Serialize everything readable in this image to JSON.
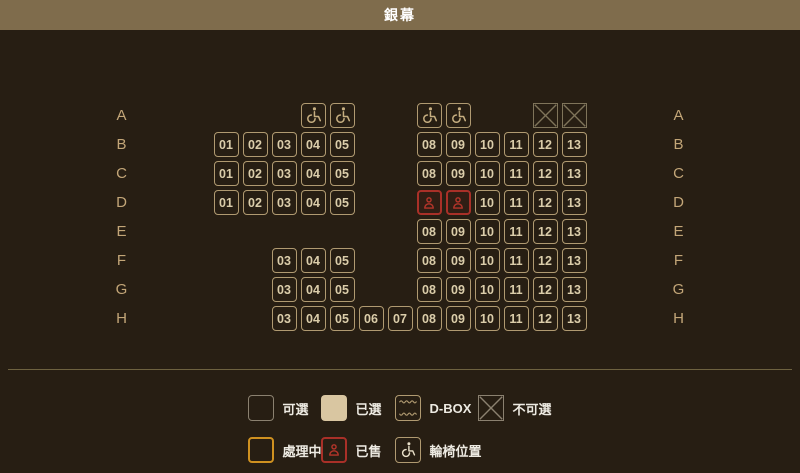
{
  "header": {
    "title": "銀幕"
  },
  "seat_map": {
    "columns": 13,
    "rows": [
      {
        "label": "A",
        "seats": [
          {
            "col": 4,
            "type": "wheelchair"
          },
          {
            "col": 5,
            "type": "wheelchair"
          },
          {
            "col": 8,
            "type": "wheelchair"
          },
          {
            "col": 9,
            "type": "wheelchair"
          },
          {
            "col": 12,
            "type": "blocked"
          },
          {
            "col": 13,
            "type": "blocked"
          }
        ]
      },
      {
        "label": "B",
        "seats": [
          {
            "col": 1,
            "type": "seat",
            "label": "01"
          },
          {
            "col": 2,
            "type": "seat",
            "label": "02"
          },
          {
            "col": 3,
            "type": "seat",
            "label": "03"
          },
          {
            "col": 4,
            "type": "seat",
            "label": "04"
          },
          {
            "col": 5,
            "type": "seat",
            "label": "05"
          },
          {
            "col": 8,
            "type": "seat",
            "label": "08"
          },
          {
            "col": 9,
            "type": "seat",
            "label": "09"
          },
          {
            "col": 10,
            "type": "seat",
            "label": "10"
          },
          {
            "col": 11,
            "type": "seat",
            "label": "11"
          },
          {
            "col": 12,
            "type": "seat",
            "label": "12"
          },
          {
            "col": 13,
            "type": "seat",
            "label": "13"
          }
        ]
      },
      {
        "label": "C",
        "seats": [
          {
            "col": 1,
            "type": "seat",
            "label": "01"
          },
          {
            "col": 2,
            "type": "seat",
            "label": "02"
          },
          {
            "col": 3,
            "type": "seat",
            "label": "03"
          },
          {
            "col": 4,
            "type": "seat",
            "label": "04"
          },
          {
            "col": 5,
            "type": "seat",
            "label": "05"
          },
          {
            "col": 8,
            "type": "seat",
            "label": "08"
          },
          {
            "col": 9,
            "type": "seat",
            "label": "09"
          },
          {
            "col": 10,
            "type": "seat",
            "label": "10"
          },
          {
            "col": 11,
            "type": "seat",
            "label": "11"
          },
          {
            "col": 12,
            "type": "seat",
            "label": "12"
          },
          {
            "col": 13,
            "type": "seat",
            "label": "13"
          }
        ]
      },
      {
        "label": "D",
        "seats": [
          {
            "col": 1,
            "type": "seat",
            "label": "01"
          },
          {
            "col": 2,
            "type": "seat",
            "label": "02"
          },
          {
            "col": 3,
            "type": "seat",
            "label": "03"
          },
          {
            "col": 4,
            "type": "seat",
            "label": "04"
          },
          {
            "col": 5,
            "type": "seat",
            "label": "05"
          },
          {
            "col": 8,
            "type": "sold"
          },
          {
            "col": 9,
            "type": "sold"
          },
          {
            "col": 10,
            "type": "seat",
            "label": "10"
          },
          {
            "col": 11,
            "type": "seat",
            "label": "11"
          },
          {
            "col": 12,
            "type": "seat",
            "label": "12"
          },
          {
            "col": 13,
            "type": "seat",
            "label": "13"
          }
        ]
      },
      {
        "label": "E",
        "seats": [
          {
            "col": 8,
            "type": "seat",
            "label": "08"
          },
          {
            "col": 9,
            "type": "seat",
            "label": "09"
          },
          {
            "col": 10,
            "type": "seat",
            "label": "10"
          },
          {
            "col": 11,
            "type": "seat",
            "label": "11"
          },
          {
            "col": 12,
            "type": "seat",
            "label": "12"
          },
          {
            "col": 13,
            "type": "seat",
            "label": "13"
          }
        ]
      },
      {
        "label": "F",
        "seats": [
          {
            "col": 3,
            "type": "seat",
            "label": "03"
          },
          {
            "col": 4,
            "type": "seat",
            "label": "04"
          },
          {
            "col": 5,
            "type": "seat",
            "label": "05"
          },
          {
            "col": 8,
            "type": "seat",
            "label": "08"
          },
          {
            "col": 9,
            "type": "seat",
            "label": "09"
          },
          {
            "col": 10,
            "type": "seat",
            "label": "10"
          },
          {
            "col": 11,
            "type": "seat",
            "label": "11"
          },
          {
            "col": 12,
            "type": "seat",
            "label": "12"
          },
          {
            "col": 13,
            "type": "seat",
            "label": "13"
          }
        ]
      },
      {
        "label": "G",
        "seats": [
          {
            "col": 3,
            "type": "seat",
            "label": "03"
          },
          {
            "col": 4,
            "type": "seat",
            "label": "04"
          },
          {
            "col": 5,
            "type": "seat",
            "label": "05"
          },
          {
            "col": 8,
            "type": "seat",
            "label": "08"
          },
          {
            "col": 9,
            "type": "seat",
            "label": "09"
          },
          {
            "col": 10,
            "type": "seat",
            "label": "10"
          },
          {
            "col": 11,
            "type": "seat",
            "label": "11"
          },
          {
            "col": 12,
            "type": "seat",
            "label": "12"
          },
          {
            "col": 13,
            "type": "seat",
            "label": "13"
          }
        ]
      },
      {
        "label": "H",
        "seats": [
          {
            "col": 3,
            "type": "seat",
            "label": "03"
          },
          {
            "col": 4,
            "type": "seat",
            "label": "04"
          },
          {
            "col": 5,
            "type": "seat",
            "label": "05"
          },
          {
            "col": 6,
            "type": "seat",
            "label": "06"
          },
          {
            "col": 7,
            "type": "seat",
            "label": "07"
          },
          {
            "col": 8,
            "type": "seat",
            "label": "08"
          },
          {
            "col": 9,
            "type": "seat",
            "label": "09"
          },
          {
            "col": 10,
            "type": "seat",
            "label": "10"
          },
          {
            "col": 11,
            "type": "seat",
            "label": "11"
          },
          {
            "col": 12,
            "type": "seat",
            "label": "12"
          },
          {
            "col": 13,
            "type": "seat",
            "label": "13"
          }
        ]
      }
    ]
  },
  "legend": {
    "rows": [
      [
        {
          "id": "available",
          "label": "可選"
        },
        {
          "id": "selected",
          "label": "已選"
        },
        {
          "id": "dbox",
          "label": "D-BOX"
        },
        {
          "id": "blocked",
          "label": "不可選"
        }
      ],
      [
        {
          "id": "processing",
          "label": "處理中"
        },
        {
          "id": "sold",
          "label": "已售"
        },
        {
          "id": "wheelchair",
          "label": "輪椅位置"
        }
      ]
    ]
  },
  "colors": {
    "page_bg": "#271e13",
    "header_bg": "#7f6c4c",
    "header_text": "#ffffff",
    "seat_border": "#b09a71",
    "seat_text": "#dbcdaa",
    "row_label": "#c3a678",
    "wheelchair": "#c6ae80",
    "blocked": "#7f745a",
    "sold": "#a93028",
    "sold_icon": "#b5352a",
    "divider": "#6e6240",
    "legend_muted": "#8b8170",
    "selected_fill": "#d9c6a1",
    "processing": "#cf9120",
    "legend_text": "#edeae2",
    "legend_wheelchair_glyph": "#e8dfc8"
  }
}
